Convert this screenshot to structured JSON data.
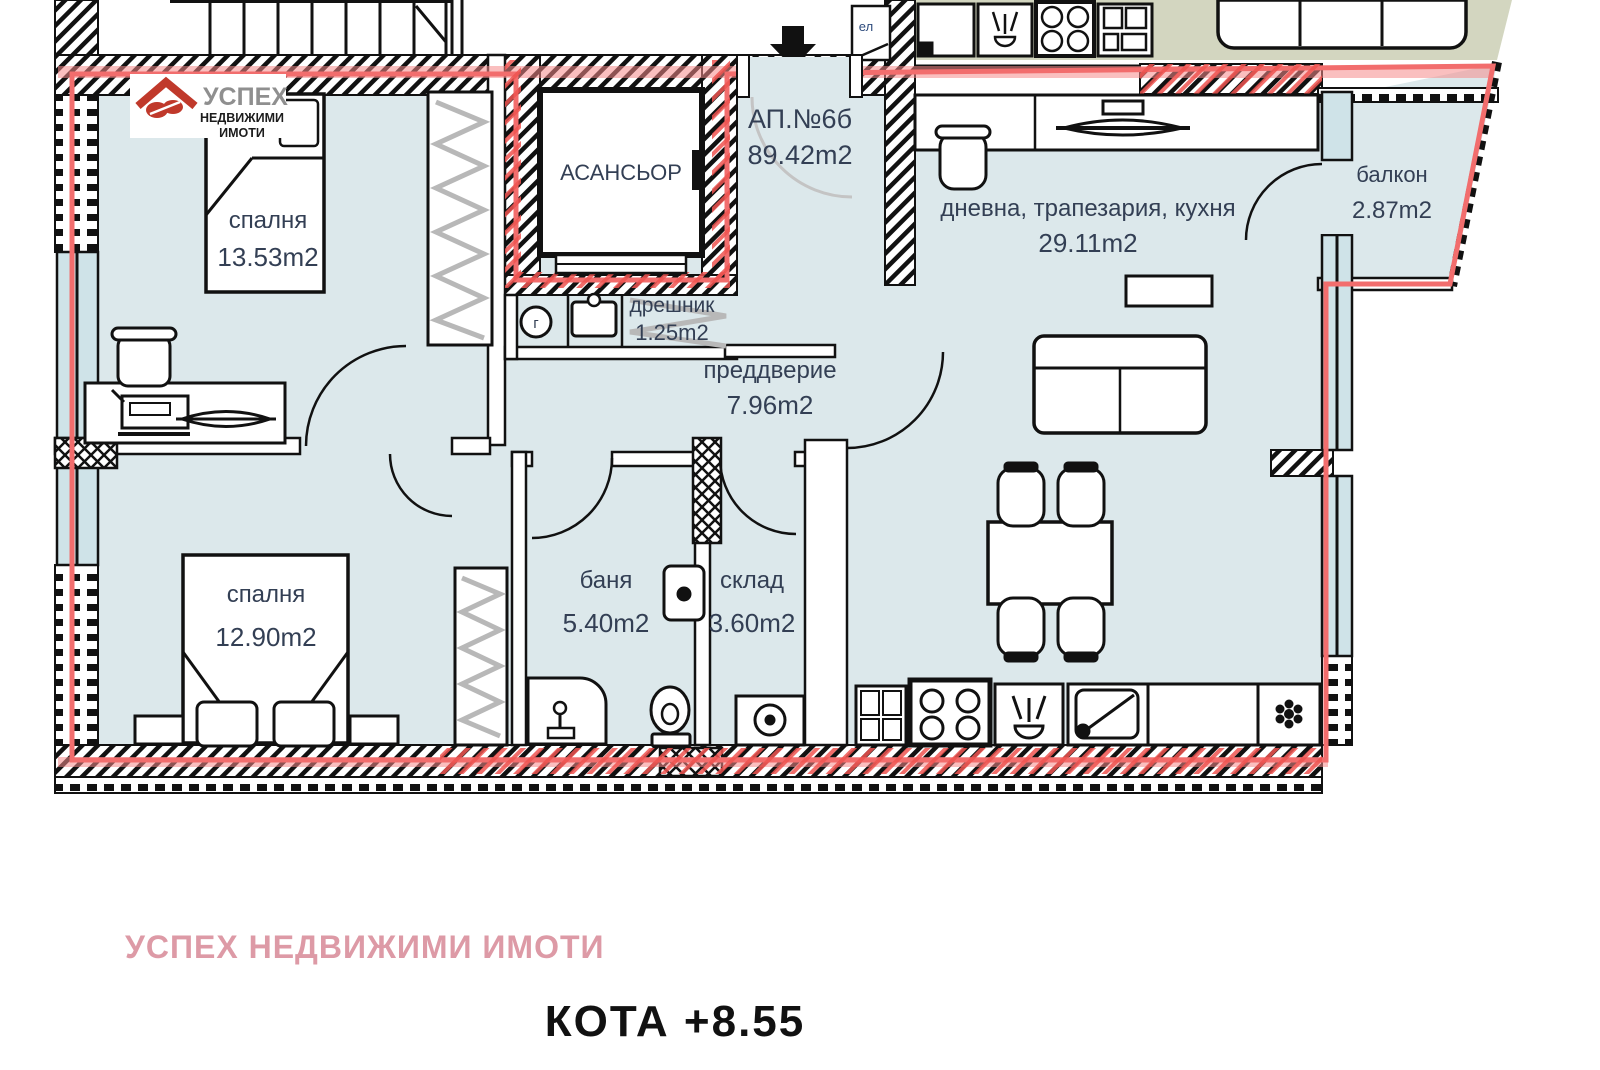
{
  "apartment": {
    "id": "АП.№6б",
    "area": "89.42m2"
  },
  "rooms": [
    {
      "name": "спалня",
      "area": "13.53m2"
    },
    {
      "name": "спалня",
      "area": "12.90m2"
    },
    {
      "name": "дневна, трапезария, кухня",
      "area": "29.11m2"
    },
    {
      "name": "балкон",
      "area": "2.87m2"
    },
    {
      "name": "дрешник",
      "area": "1.25m2"
    },
    {
      "name": "преддверие",
      "area": "7.96m2"
    },
    {
      "name": "баня",
      "area": "5.40m2"
    },
    {
      "name": "склад",
      "area": "3.60m2"
    }
  ],
  "labels": {
    "elevator": "АСАНСЬОР",
    "gas": "г",
    "electrical": "ел"
  },
  "logo": {
    "name": "УСПЕХ",
    "line1": "НЕДВИЖИМИ",
    "line2": "ИМОТИ"
  },
  "footer": {
    "agency": "УСПЕХ НЕДВИЖИМИ ИМОТИ",
    "elevation": "КОТА +8.55"
  },
  "colors": {
    "boundary_red": "#f26d6d",
    "logo_red": "#c0392b",
    "agency_pink": "#dd9aa6",
    "room_fill": "#dce8eb",
    "neighbor_fill": "#d3d6c0",
    "glass_fill": "#cfe3e8",
    "label_color": "#333f54",
    "wall_black": "#111111"
  }
}
